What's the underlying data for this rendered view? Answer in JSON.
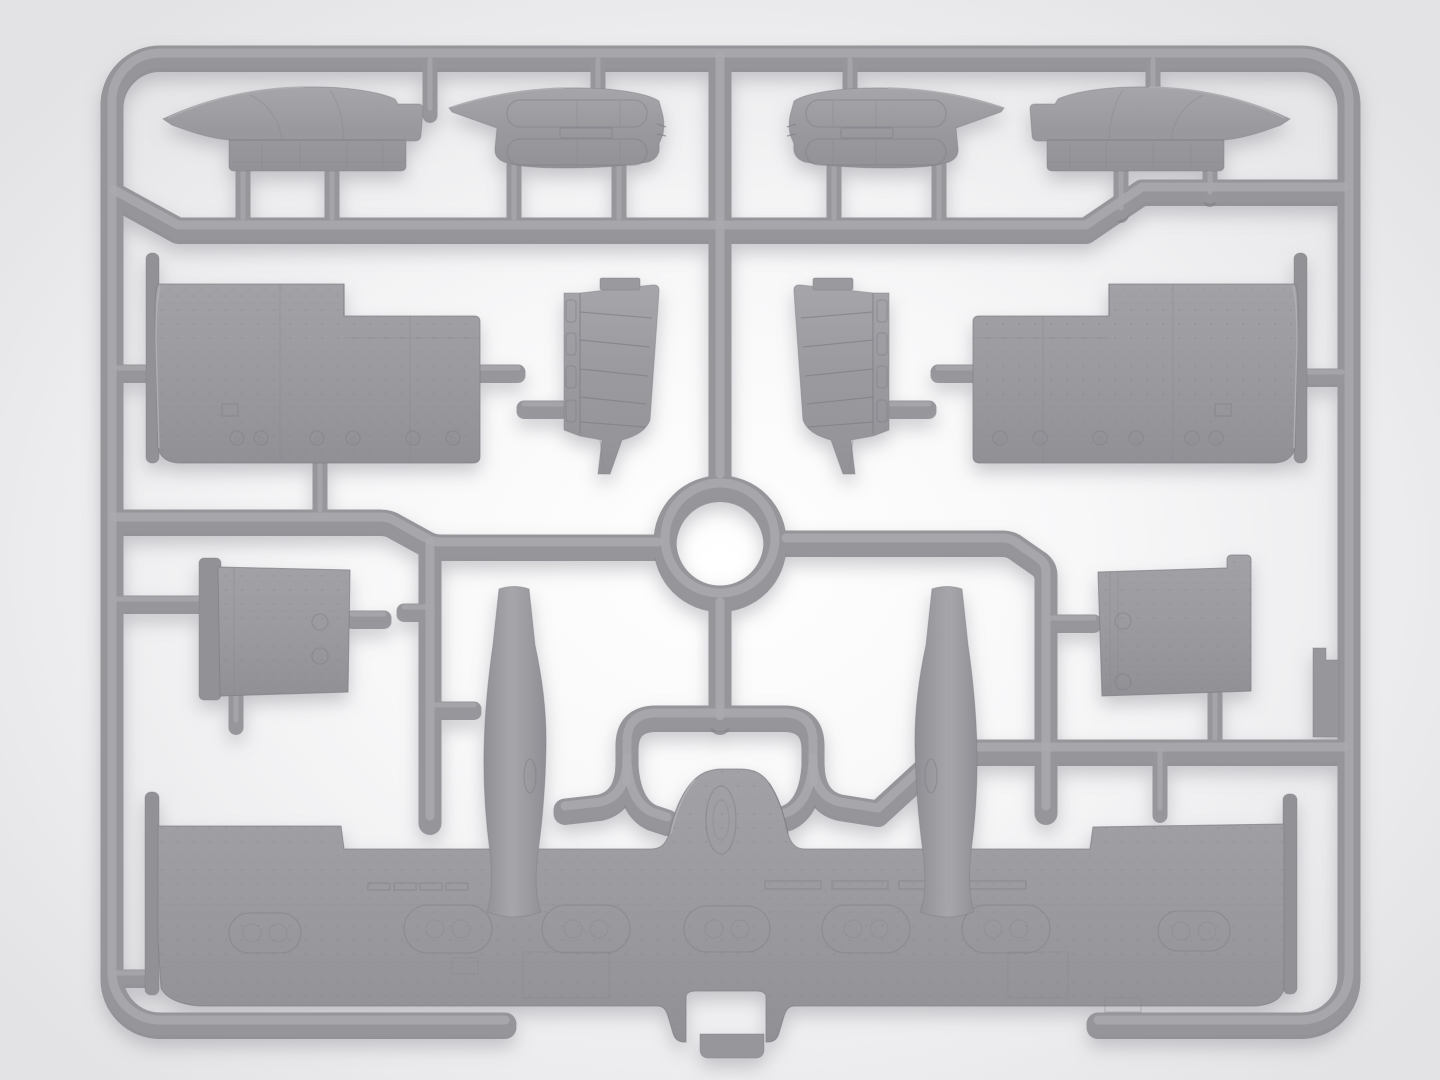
{
  "scene": {
    "description": "Product photo of a light-gray injection-molded plastic model kit sprue (parts frame) for a twin-boom aircraft kit: four nacelle top covers on the top row, two large fuselage side panels, two ribbed interior bulkheads, two small access panels, two tapered tail booms and one large one-piece lower wing, all attached to a rounded rectangular runner frame with a central circular runner ring. No text is visible in the image.",
    "subject": "plastic-model-sprue",
    "background": {
      "center": "#ffffff",
      "edge": "#e3e3e5"
    },
    "palette": {
      "plastic_base": "#95959a",
      "plastic_highlight": "#aaaaae",
      "plastic_shadow": "#85858b",
      "part_fill_light": "#a3a3a7",
      "part_fill_dark": "#929297",
      "panel_line": "#80808a"
    },
    "counts": {
      "molded_parts_on_sprue": 14,
      "runner_ring": 1
    }
  },
  "sprue": {
    "frame": {
      "left": 112,
      "top": 57,
      "right": 1349,
      "bottom": 1024,
      "corner_radius": 48,
      "bottom_gap": [
        505,
        1098
      ]
    },
    "ring": {
      "cx": 720,
      "cy": 542,
      "outer_r": 66
    },
    "parts": [
      {
        "id": "cowling-top-left",
        "name": "nacelle top cover (side view)",
        "bbox": [
          163,
          86,
          423,
          171
        ]
      },
      {
        "id": "cowling-bottom-left",
        "name": "nacelle cover (underside view)",
        "bbox": [
          449,
          87,
          664,
          168
        ]
      },
      {
        "id": "cowling-bottom-right",
        "name": "nacelle cover (underside view, mirrored)",
        "bbox": [
          789,
          87,
          1005,
          168
        ]
      },
      {
        "id": "cowling-top-right",
        "name": "nacelle top cover (mirrored)",
        "bbox": [
          1031,
          86,
          1290,
          171
        ]
      },
      {
        "id": "fuselage-panel-left",
        "name": "large fuselage side panel",
        "bbox": [
          146,
          253,
          481,
          463
        ]
      },
      {
        "id": "fuselage-panel-right",
        "name": "large fuselage side panel (mirrored)",
        "bbox": [
          972,
          253,
          1307,
          463
        ]
      },
      {
        "id": "ribbed-bulkhead-left",
        "name": "ribbed interior bulkhead",
        "bbox": [
          564,
          280,
          660,
          474
        ]
      },
      {
        "id": "ribbed-bulkhead-right",
        "name": "ribbed interior bulkhead (mirrored)",
        "bbox": [
          793,
          280,
          889,
          474
        ]
      },
      {
        "id": "access-panel-left",
        "name": "small riveted access panel",
        "bbox": [
          199,
          558,
          352,
          696
        ]
      },
      {
        "id": "access-panel-right",
        "name": "small riveted access panel",
        "bbox": [
          1098,
          555,
          1251,
          696
        ]
      },
      {
        "id": "tail-boom-left",
        "name": "tapered tail boom",
        "bbox": [
          484,
          584,
          546,
          917
        ]
      },
      {
        "id": "tail-boom-right",
        "name": "tapered tail boom (mirrored)",
        "bbox": [
          915,
          584,
          977,
          917
        ]
      },
      {
        "id": "lower-wing",
        "name": "one-piece lower wing with center hump",
        "bbox": [
          145,
          769,
          1297,
          1059
        ]
      },
      {
        "id": "blade-stub-part",
        "name": "small blade part molded on right rail",
        "bbox": [
          1313,
          648,
          1339,
          737
        ]
      }
    ],
    "gates_vertical": [
      {
        "x": 243,
        "y1": 160,
        "y2": 222
      },
      {
        "x": 332,
        "y1": 160,
        "y2": 222
      },
      {
        "x": 514,
        "y1": 166,
        "y2": 222
      },
      {
        "x": 619,
        "y1": 166,
        "y2": 222
      },
      {
        "x": 834,
        "y1": 166,
        "y2": 222
      },
      {
        "x": 939,
        "y1": 166,
        "y2": 222
      },
      {
        "x": 1121,
        "y1": 160,
        "y2": 212
      },
      {
        "x": 1210,
        "y1": 160,
        "y2": 196
      },
      {
        "x": 430,
        "y1": 64,
        "y2": 112
      },
      {
        "x": 598,
        "y1": 64,
        "y2": 92
      },
      {
        "x": 850,
        "y1": 64,
        "y2": 94
      },
      {
        "x": 1153,
        "y1": 64,
        "y2": 110
      },
      {
        "x": 320,
        "y1": 460,
        "y2": 514
      },
      {
        "x": 236,
        "y1": 693,
        "y2": 724
      },
      {
        "x": 1215,
        "y1": 694,
        "y2": 742
      },
      {
        "x": 1160,
        "y1": 752,
        "y2": 812
      }
    ],
    "gates_horizontal": [
      {
        "y": 372,
        "x1": 114,
        "x2": 150
      },
      {
        "y": 372,
        "x1": 480,
        "x2": 518
      },
      {
        "y": 408,
        "x1": 524,
        "x2": 562
      },
      {
        "y": 408,
        "x1": 891,
        "x2": 929
      },
      {
        "y": 603,
        "x1": 114,
        "x2": 224
      },
      {
        "y": 618,
        "x1": 352,
        "x2": 384
      },
      {
        "y": 611,
        "x1": 404,
        "x2": 430
      },
      {
        "y": 622,
        "x1": 1046,
        "x2": 1094
      },
      {
        "y": 372,
        "x1": 938,
        "x2": 974
      },
      {
        "y": 376,
        "x1": 1306,
        "x2": 1342
      },
      {
        "y": 977,
        "x1": 116,
        "x2": 146
      },
      {
        "y": 709,
        "x1": 430,
        "x2": 474
      }
    ],
    "wing_details": {
      "dash_rows": [
        {
          "x": 368,
          "y": 883,
          "w": 22,
          "h": 7
        },
        {
          "x": 394,
          "y": 883,
          "w": 22,
          "h": 7
        },
        {
          "x": 420,
          "y": 883,
          "w": 22,
          "h": 7
        },
        {
          "x": 446,
          "y": 883,
          "w": 22,
          "h": 7
        },
        {
          "x": 765,
          "y": 881,
          "w": 56,
          "h": 8
        },
        {
          "x": 832,
          "y": 881,
          "w": 56,
          "h": 8
        },
        {
          "x": 899,
          "y": 881,
          "w": 56,
          "h": 8
        },
        {
          "x": 966,
          "y": 881,
          "w": 60,
          "h": 8
        }
      ],
      "nacelle_bays": [
        {
          "cx": 265,
          "cy": 933,
          "w": 72,
          "h": 40
        },
        {
          "cx": 448,
          "cy": 929,
          "w": 88,
          "h": 48
        },
        {
          "cx": 586,
          "cy": 929,
          "w": 88,
          "h": 48
        },
        {
          "cx": 727,
          "cy": 929,
          "w": 86,
          "h": 46
        },
        {
          "cx": 866,
          "cy": 929,
          "w": 88,
          "h": 48
        },
        {
          "cx": 1006,
          "cy": 929,
          "w": 88,
          "h": 48
        },
        {
          "cx": 1194,
          "cy": 931,
          "w": 72,
          "h": 40
        }
      ],
      "panel_rects": [
        {
          "x": 523,
          "y": 952,
          "w": 86,
          "h": 46
        },
        {
          "x": 1008,
          "y": 952,
          "w": 60,
          "h": 46
        },
        {
          "x": 452,
          "y": 958,
          "w": 26,
          "h": 16
        },
        {
          "x": 1105,
          "y": 998,
          "w": 36,
          "h": 14
        }
      ]
    },
    "fuselage_panel_circles": {
      "y": 438,
      "r": 7,
      "xs": [
        237,
        261,
        317,
        353,
        413,
        453
      ]
    }
  }
}
